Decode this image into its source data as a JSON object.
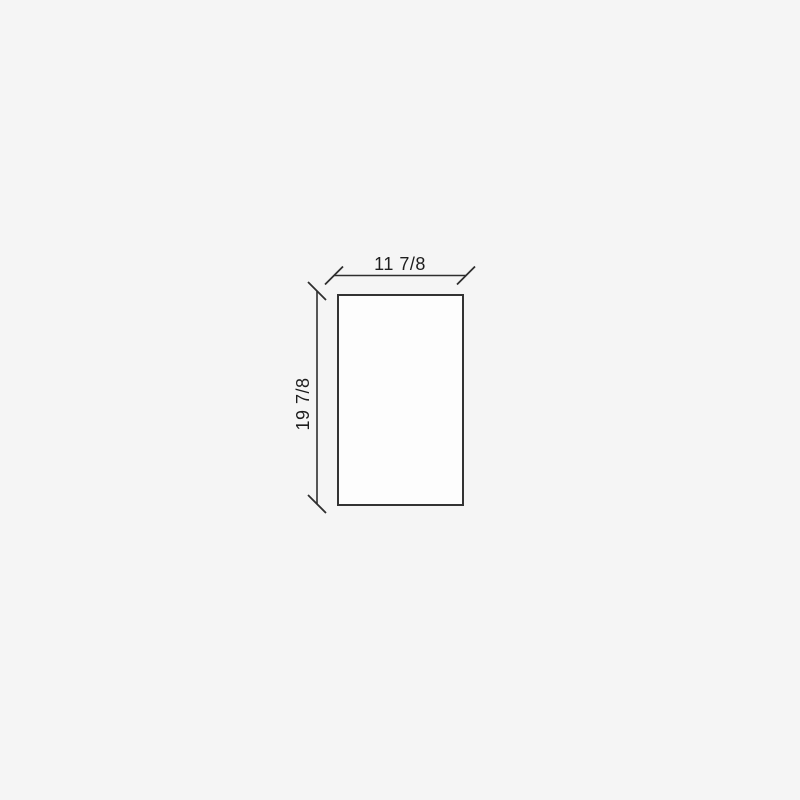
{
  "drawing": {
    "width_label": "11 7/8",
    "height_label": "19 7/8",
    "colors": {
      "background": "#f5f5f5",
      "line": "#333333",
      "text": "#1d1d1d",
      "shape_fill": "#fdfdfd"
    }
  }
}
